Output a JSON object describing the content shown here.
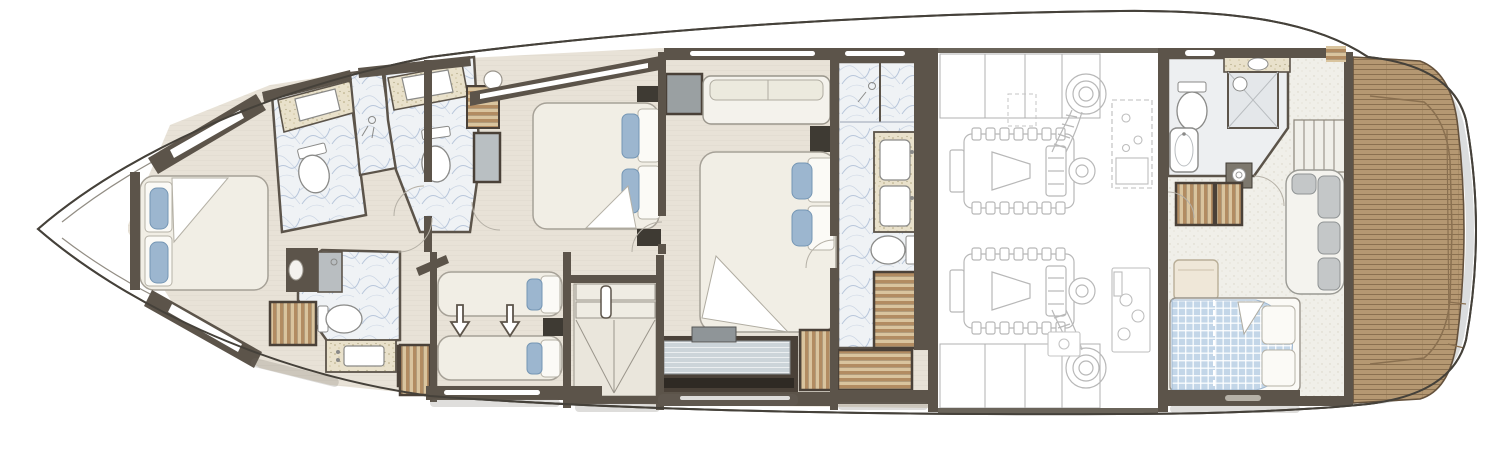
{
  "diagram": {
    "type": "Yacht lower deck floor plan",
    "regions": [
      "bow",
      "vip-cabin-forward",
      "vip-bathroom-port",
      "shower-compartment-forward",
      "guest-bathroom-port",
      "twin-bathroom-starboard",
      "twin-guest-cabin",
      "guest-double-cabin",
      "companionway-stairs",
      "master-stateroom",
      "master-bathroom",
      "engine-room",
      "crew-quarters",
      "crew-bathroom",
      "crew-lounge",
      "aft-teak-platform"
    ],
    "fixtures": [
      "double-bed",
      "single-bed",
      "pillows",
      "wardrobe",
      "vanity-sink",
      "toilet",
      "shower",
      "bathtub",
      "washer",
      "sofa",
      "dresser-tv",
      "engine",
      "exhaust",
      "stairs",
      "wood-grating",
      "slide-arrows",
      "door-swing"
    ]
  },
  "palette": {
    "hull_line": "#45413a",
    "wall": "#5c544a",
    "wall_dark": "#3e3a33",
    "floor": "#e8e2d7",
    "floor_line": "#d8d1c4",
    "marble_base": "#eff2f5",
    "marble_vein": "#a9bad3",
    "counter": "#e9e1cb",
    "counter_dot": "#b4a87f",
    "crewfloor": "#f0efe9",
    "crewfloor_dot": "#d8d4c6",
    "teak": "#b59872",
    "teak_line": "#8a7050",
    "teak_edge": "#64513c",
    "slat_light": "#d9c49e",
    "slat_dark": "#b28c62",
    "slat_frame": "#4a4138",
    "bed": "#f1eee5",
    "bed_line": "#a6a197",
    "pillow_blue": "#9cb6cf",
    "pillow_edge": "#7596b4",
    "blanket_blue": "#c3d6e8",
    "sofa_gray": "#c4c7c8",
    "glass": "#ccd4d9",
    "engine_line": "#b8b8b8",
    "fixture_line": "#8a8a88",
    "rim_shade": "#d2d4d6",
    "arc_line": "#b5b0a6",
    "shadow": "#6f6a61"
  }
}
